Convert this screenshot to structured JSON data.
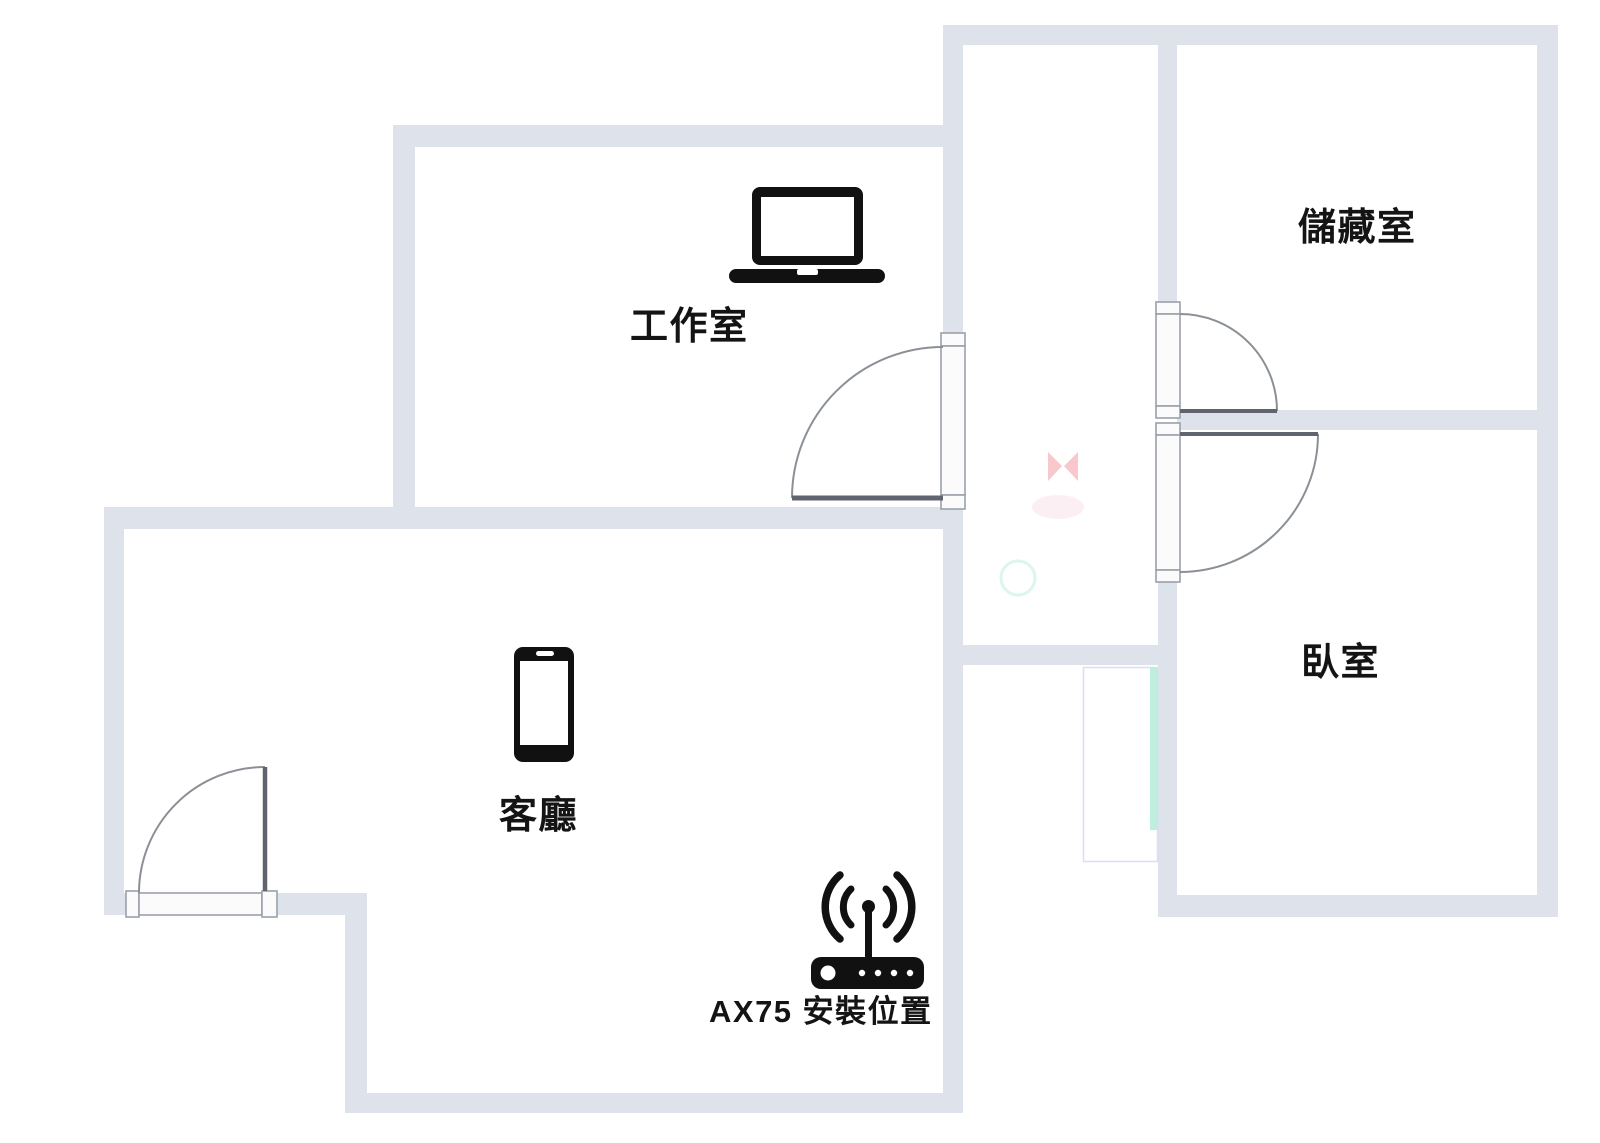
{
  "floorplan": {
    "title": "apartment-floor-plan",
    "rooms": {
      "studio": {
        "label": "工作室"
      },
      "storage": {
        "label": "儲藏室"
      },
      "bedroom": {
        "label": "臥室"
      },
      "living": {
        "label": "客廳"
      }
    },
    "router": {
      "label": "AX75 安裝位置",
      "model": "AX75"
    },
    "icons": {
      "studio_device": "laptop-icon",
      "living_device": "smartphone-icon",
      "router_device": "wifi-router-icon"
    },
    "colors": {
      "wall": "#dee2ea",
      "door_frame_fill": "#fbfbfc",
      "door_frame_stroke": "#9aa0ab",
      "door_arc": "#8b9097",
      "door_slab": "#5f646e",
      "icon": "#111111",
      "label": "#141414",
      "remnant_mint": "rgba(147,228,196,0.60)",
      "remnant_outline": "rgba(187,196,232,0.55)",
      "remnant_pink": "rgba(233,74,88,0.30)",
      "remnant_pink_soft": "rgba(242,180,200,0.22)",
      "remnant_mint_soft": "rgba(160,232,202,0.38)"
    }
  }
}
